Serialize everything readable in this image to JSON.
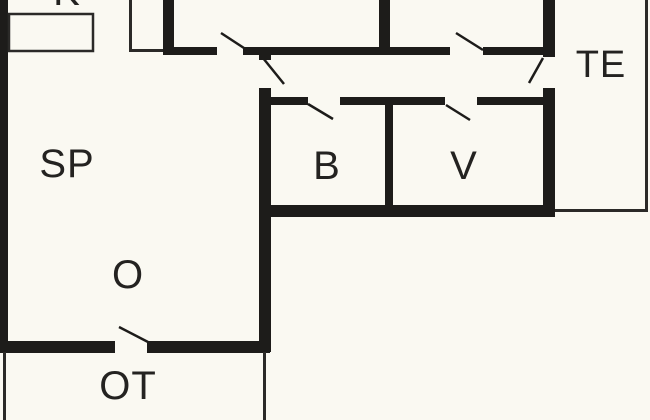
{
  "plan": {
    "type": "floor-plan",
    "rooms": {
      "sp": {
        "label": "SP"
      },
      "o": {
        "label": "O"
      },
      "b": {
        "label": "B"
      },
      "v": {
        "label": "V"
      },
      "te": {
        "label": "TE"
      },
      "ot": {
        "label": "OT"
      },
      "k": {
        "label": "K"
      }
    }
  },
  "colors": {
    "background": "#faf9f2",
    "wall": "#1d1c1a",
    "line": "#2b2a28",
    "text": "#242321"
  }
}
